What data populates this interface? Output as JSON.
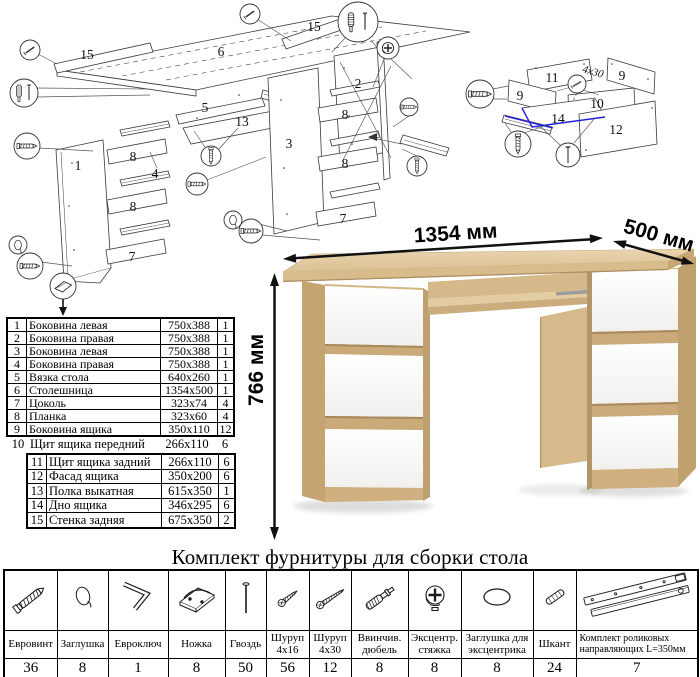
{
  "product": {
    "width": "1354 мм",
    "depth": "500 мм",
    "height": "766 мм"
  },
  "parts_table": {
    "rows": [
      {
        "num": "1",
        "name": "Боковина левая",
        "size": "750x388",
        "qty": "1"
      },
      {
        "num": "2",
        "name": "Боковина правая",
        "size": "750x388",
        "qty": "1"
      },
      {
        "num": "3",
        "name": "Боковина левая",
        "size": "750x388",
        "qty": "1"
      },
      {
        "num": "4",
        "name": "Боковина правая",
        "size": "750x388",
        "qty": "1"
      },
      {
        "num": "5",
        "name": "Вязка стола",
        "size": "640x260",
        "qty": "1"
      },
      {
        "num": "6",
        "name": "Столешница",
        "size": "1354x500",
        "qty": "1"
      },
      {
        "num": "7",
        "name": "Цоколь",
        "size": "323x74",
        "qty": "4"
      },
      {
        "num": "8",
        "name": "Планка",
        "size": "323x60",
        "qty": "4"
      },
      {
        "num": "9",
        "name": "Боковина ящика",
        "size": "350x110",
        "qty": "12"
      },
      {
        "num": "10",
        "name": "Щит ящика передний",
        "size": "266x110",
        "qty": "6"
      },
      {
        "num": "11",
        "name": "Щит ящика задний",
        "size": "266x110",
        "qty": "6"
      },
      {
        "num": "12",
        "name": "Фасад ящика",
        "size": "350x200",
        "qty": "6"
      },
      {
        "num": "13",
        "name": "Полка выкатная",
        "size": "615x350",
        "qty": "1"
      },
      {
        "num": "14",
        "name": "Дно ящика",
        "size": "346x295",
        "qty": "6"
      },
      {
        "num": "15",
        "name": "Стенка задняя",
        "size": "675x350",
        "qty": "2"
      }
    ]
  },
  "hardware": {
    "title": "Комплект фурнитуры для сборки стола",
    "items": [
      {
        "name": "Евровинт",
        "qty": "36",
        "icon": "confirmat-screw"
      },
      {
        "name": "Заглушка",
        "qty": "8",
        "icon": "cover-cap"
      },
      {
        "name": "Евроключ",
        "qty": "1",
        "icon": "hex-key"
      },
      {
        "name": "Ножка",
        "qty": "8",
        "icon": "foot"
      },
      {
        "name": "Гвоздь",
        "qty": "50",
        "icon": "nail"
      },
      {
        "name": "Шуруп\n4x16",
        "qty": "56",
        "icon": "screw-4x16"
      },
      {
        "name": "Шуруп\n4x30",
        "qty": "12",
        "icon": "screw-4x30"
      },
      {
        "name": "Ввинчив.\nдюбель",
        "qty": "8",
        "icon": "screw-in-dowel"
      },
      {
        "name": "Эксцентр.\nстяжка",
        "qty": "8",
        "icon": "cam-lock"
      },
      {
        "name": "Заглушка для\nэксцентрика",
        "qty": "8",
        "icon": "cam-cover"
      },
      {
        "name": "Шкант",
        "qty": "24",
        "icon": "wood-dowel"
      },
      {
        "name": "Комплект роликовых\nнаправляющих L=350мм",
        "qty": "7",
        "icon": "roller-slides"
      }
    ]
  },
  "diagram_main": {
    "p15_left": "15",
    "p6": "6",
    "p15_top": "15",
    "p5": "5",
    "p13": "13",
    "p1": "1",
    "p8_a": "8",
    "p4": "4",
    "p8_b": "8",
    "p7_a": "7",
    "p3": "3",
    "p2": "2",
    "p8_c": "8",
    "p8_d": "8",
    "p7_b": "7"
  },
  "diagram_drawer": {
    "p11": "11",
    "p9_a": "9",
    "p9_b": "9",
    "p10": "10",
    "p14": "14",
    "p12": "12",
    "screw_note": "4x30"
  },
  "colors": {
    "oak_front": "#d3b686",
    "oak_top": "#e2cba1",
    "oak_side": "#c0a06c",
    "drawer_white": "#fbfbfa",
    "highlight_blue": "#2020dd",
    "line": "#3a3a3a"
  }
}
